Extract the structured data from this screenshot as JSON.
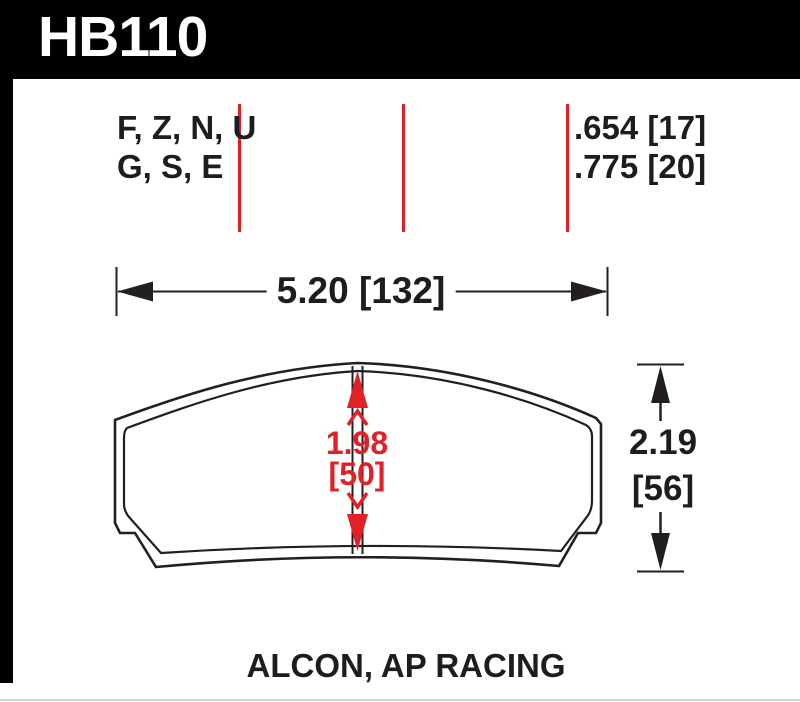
{
  "header": {
    "part_number": "HB110"
  },
  "colors": {
    "accent_red": "#e02127",
    "line_black": "#231f20",
    "header_bg": "#010101",
    "header_text": "#ffffff"
  },
  "compound_codes": {
    "line1": "F, Z, N, U",
    "line2": "G, S, E"
  },
  "pad_thickness": {
    "line1": ".654 [17]",
    "line2": ".775 [20]"
  },
  "dimensions": {
    "pad_width": "5.20 [132]",
    "center_height_in": "1.98",
    "center_height_mm": "[50]",
    "overall_height_in": "2.19",
    "overall_height_mm": "[56]"
  },
  "footer": {
    "applications": "ALCON, AP RACING"
  }
}
